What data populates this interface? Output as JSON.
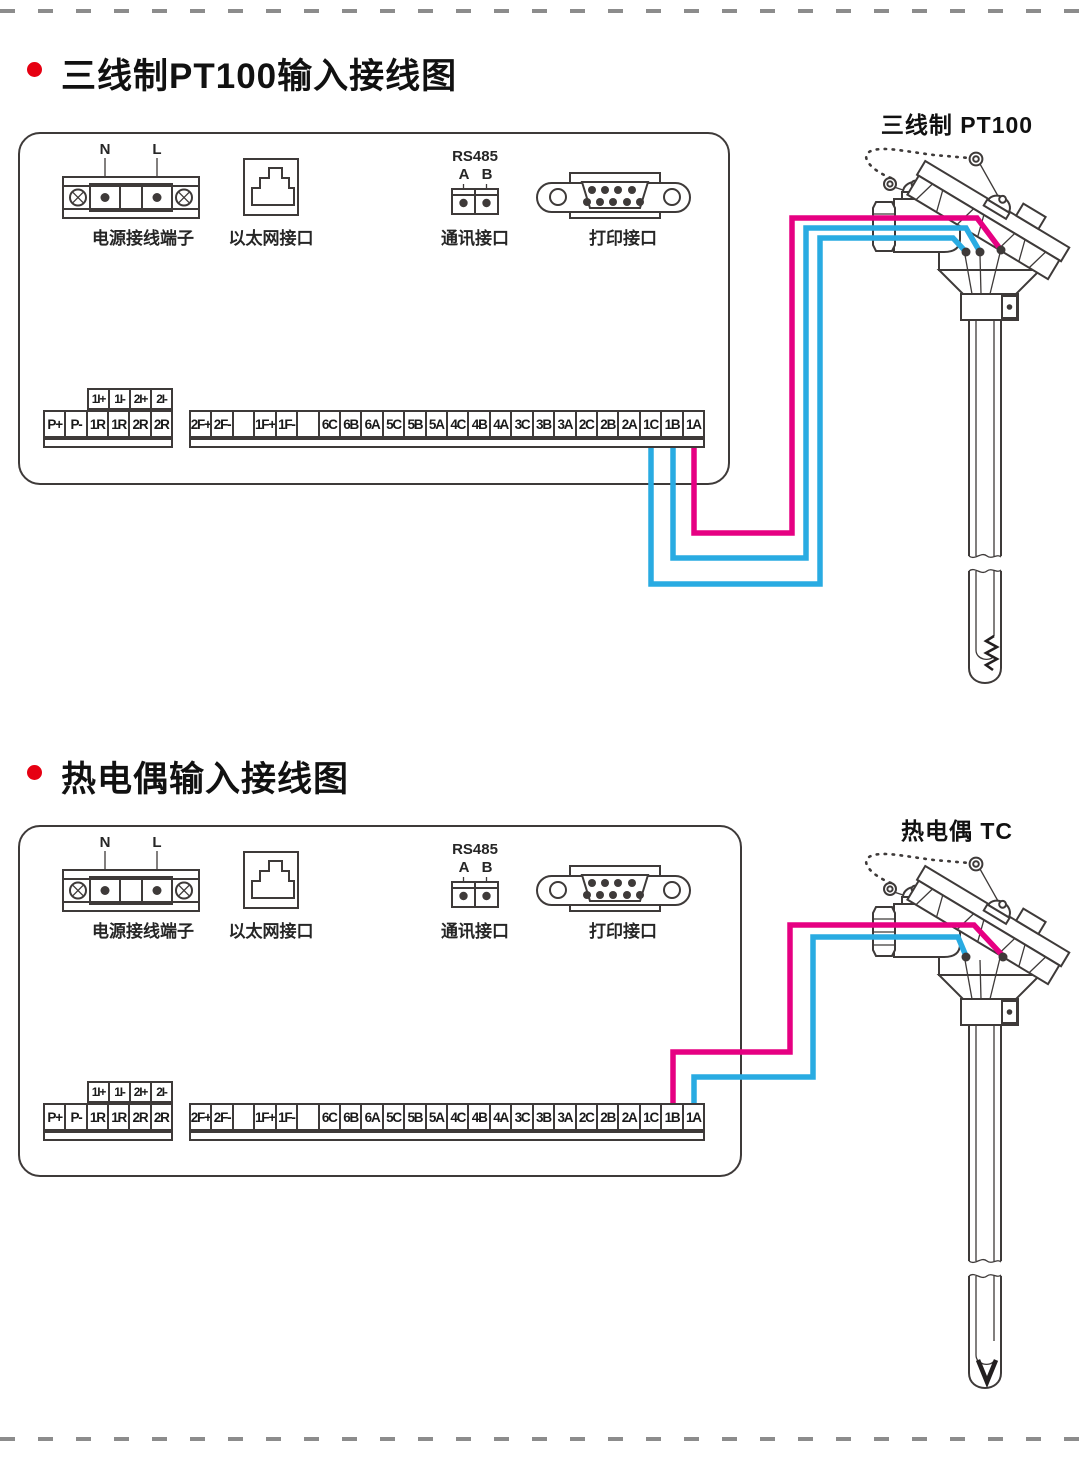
{
  "colors": {
    "line": "#3e3a39",
    "wire_magenta": "#e60082",
    "wire_blue": "#29abe2",
    "accent_red": "#e60012",
    "dash": "#8c8c8c"
  },
  "sections": [
    {
      "title": "三线制PT100输入接线图",
      "sensor_label": "三线制 PT100"
    },
    {
      "title": "热电偶输入接线图",
      "sensor_label": "热电偶 TC"
    }
  ],
  "panel": {
    "power": {
      "label": "电源接线端子",
      "pin_left": "N",
      "pin_right": "L"
    },
    "ethernet": {
      "label": "以太网接口"
    },
    "comm": {
      "label": "通讯接口",
      "bus": "RS485",
      "pin_a": "A",
      "pin_b": "B"
    },
    "printer": {
      "label": "打印接口"
    }
  },
  "terminal_strip": {
    "aux_header": [
      "1I+",
      "1I-",
      "2I+",
      "2I-"
    ],
    "left_row": [
      "P+",
      "P-",
      "1R",
      "1R",
      "2R",
      "2R"
    ],
    "right_row": [
      "2F+",
      "2F-",
      "",
      "1F+",
      "1F-",
      "",
      "6C",
      "6B",
      "6A",
      "5C",
      "5B",
      "5A",
      "4C",
      "4B",
      "4A",
      "3C",
      "3B",
      "3A",
      "2C",
      "2B",
      "2A",
      "1C",
      "1B",
      "1A"
    ]
  }
}
